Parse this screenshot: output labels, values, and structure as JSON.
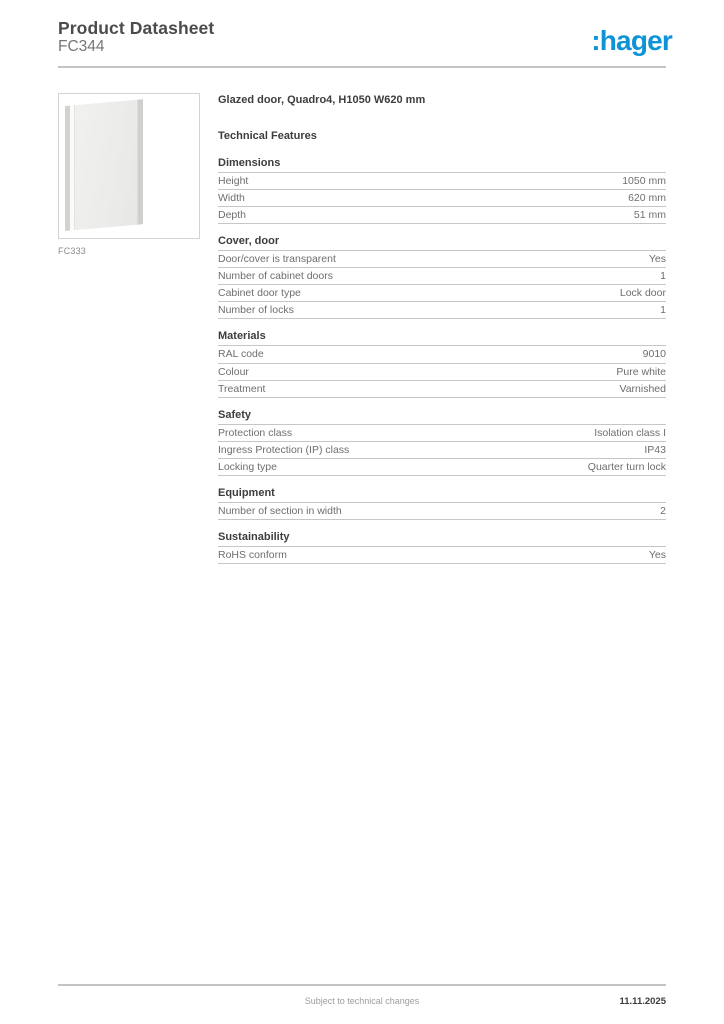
{
  "header": {
    "title": "Product Datasheet",
    "reference": "FC344"
  },
  "logo": {
    "text": ":hager",
    "color": "#0e93d6"
  },
  "product": {
    "image_caption": "FC333",
    "title": "Glazed door, Quadro4, H1050 W620 mm",
    "features_heading": "Technical Features"
  },
  "sections": [
    {
      "name": "Dimensions",
      "rows": [
        {
          "label": "Height",
          "value": "1050 mm"
        },
        {
          "label": "Width",
          "value": "620 mm"
        },
        {
          "label": "Depth",
          "value": "51 mm"
        }
      ]
    },
    {
      "name": "Cover, door",
      "rows": [
        {
          "label": "Door/cover is transparent",
          "value": "Yes"
        },
        {
          "label": "Number of cabinet doors",
          "value": "1"
        },
        {
          "label": "Cabinet door type",
          "value": "Lock door"
        },
        {
          "label": "Number of locks",
          "value": "1"
        }
      ]
    },
    {
      "name": "Materials",
      "rows": [
        {
          "label": "RAL code",
          "value": "9010"
        },
        {
          "label": "Colour",
          "value": "Pure white"
        },
        {
          "label": "Treatment",
          "value": "Varnished"
        }
      ]
    },
    {
      "name": "Safety",
      "rows": [
        {
          "label": "Protection class",
          "value": "Isolation class I"
        },
        {
          "label": "Ingress Protection (IP) class",
          "value": "IP43"
        },
        {
          "label": "Locking type",
          "value": "Quarter turn lock"
        }
      ]
    },
    {
      "name": "Equipment",
      "rows": [
        {
          "label": "Number of section in width",
          "value": "2"
        }
      ]
    },
    {
      "name": "Sustainability",
      "rows": [
        {
          "label": "RoHS conform",
          "value": "Yes"
        }
      ]
    }
  ],
  "footer": {
    "note": "Subject to technical changes",
    "date": "11.11.2025"
  }
}
